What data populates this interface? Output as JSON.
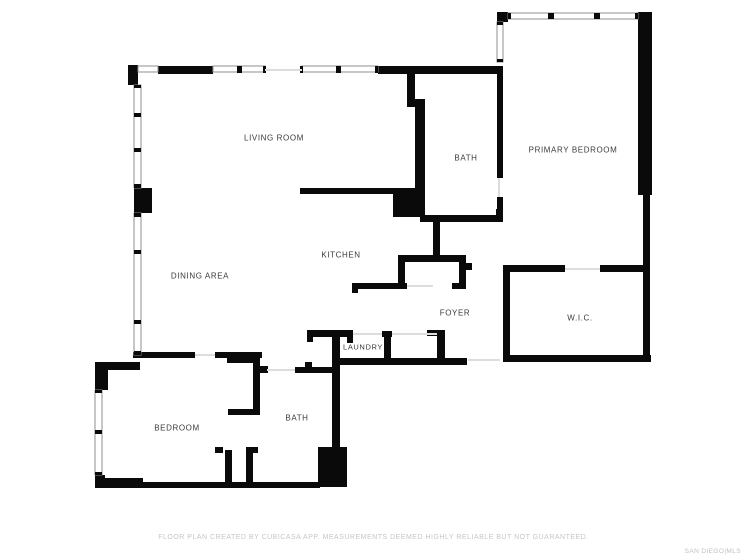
{
  "page": {
    "background_color": "#ffffff",
    "wall_color": "#0a0a0a",
    "window_stroke_color": "#8f8f8f",
    "door_opening_color": "#dddddd",
    "label_color": "#3a3a3a"
  },
  "floorplan": {
    "rooms": [
      {
        "id": "living-room",
        "label": "LIVING ROOM"
      },
      {
        "id": "dining-area",
        "label": "DINING AREA"
      },
      {
        "id": "kitchen",
        "label": "KITCHEN"
      },
      {
        "id": "bath-upper",
        "label": "BATH"
      },
      {
        "id": "primary-bedroom",
        "label": "PRIMARY BEDROOM"
      },
      {
        "id": "foyer",
        "label": "FOYER"
      },
      {
        "id": "wic",
        "label": "W.I.C."
      },
      {
        "id": "laundry",
        "label": "LAUNDRY"
      },
      {
        "id": "bedroom",
        "label": "BEDROOM"
      },
      {
        "id": "bath-lower",
        "label": "BATH"
      }
    ]
  },
  "footer": {
    "disclaimer": "FLOOR PLAN CREATED BY CUBICASA APP. MEASUREMENTS DEEMED HIGHLY RELIABLE BUT NOT GUARANTEED."
  },
  "watermark": {
    "text": "SAN DIEGO|MLS"
  }
}
